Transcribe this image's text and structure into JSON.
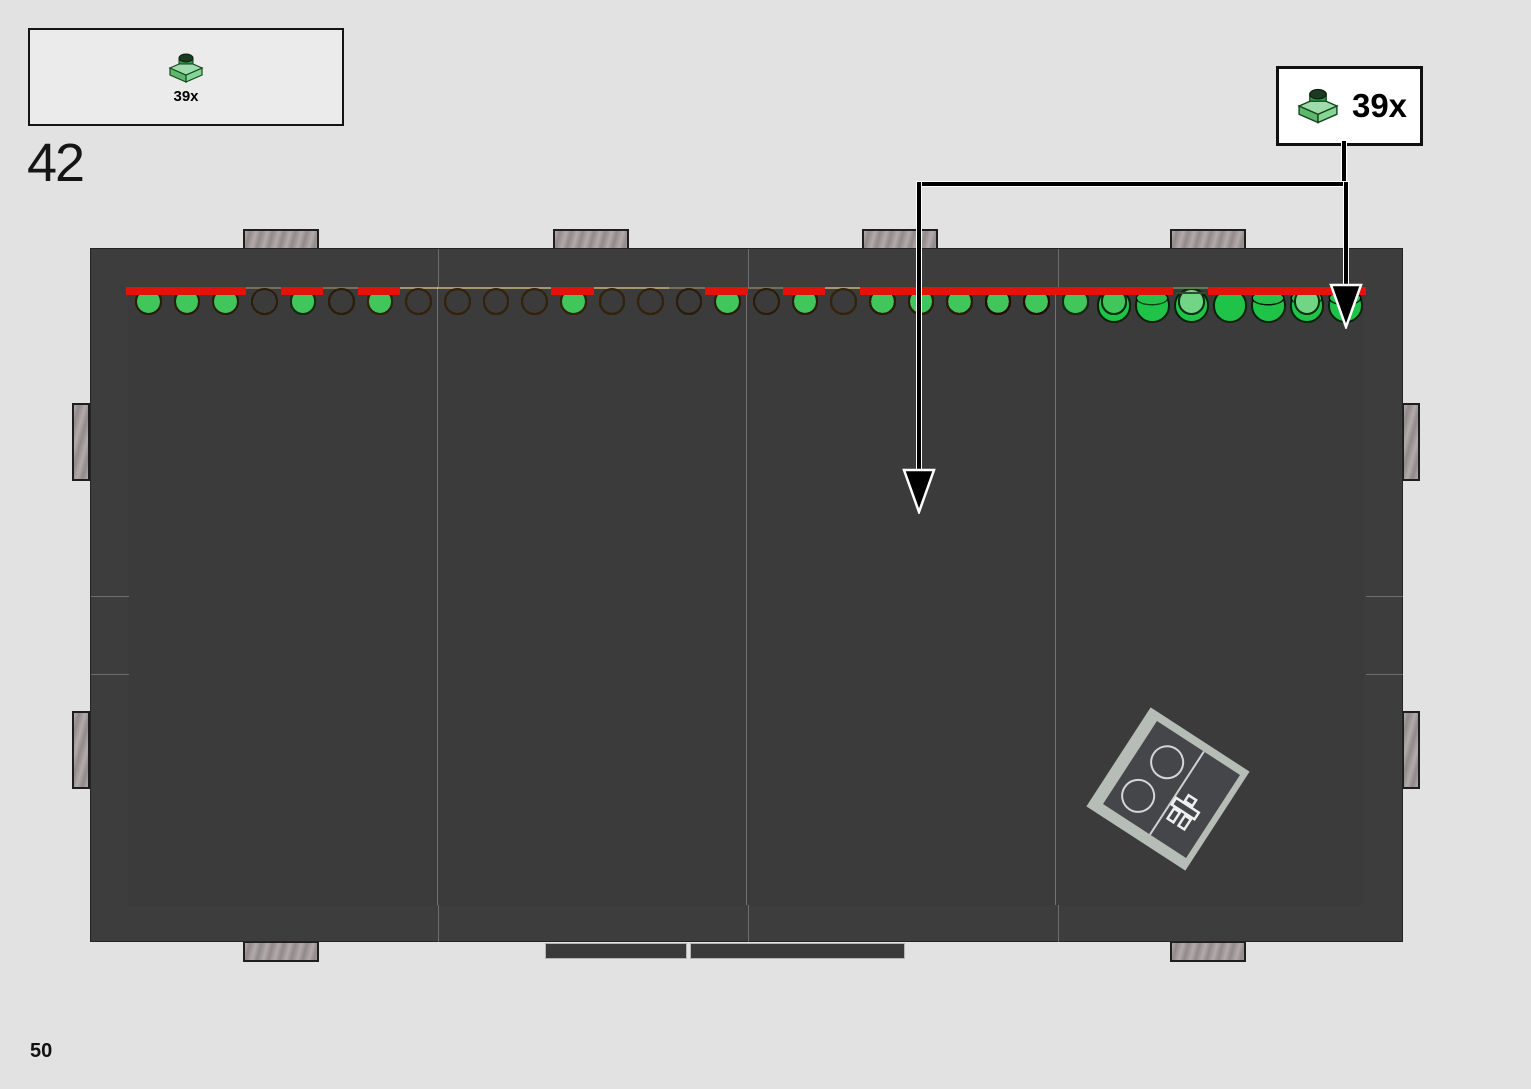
{
  "step": {
    "number": "42"
  },
  "parts_box": {
    "quantity": "39x",
    "part": "green-1x1-plate"
  },
  "callout": {
    "quantity": "39x",
    "part": "green-1x1-plate"
  },
  "page": {
    "number": "50"
  },
  "colors": {
    "page_bg": "#e2e2e2",
    "frame": "#3d3d3d",
    "red_outline": "#e41309",
    "plate_green": "#41c65b",
    "tan": "#e4d097",
    "reddish_brown": "#6f3b20"
  },
  "board": {
    "cols": 32,
    "rows": [
      "LDDDDLLDDDDLLDDDDLLttgggggtttkBB",
      "LDDDDLLDDDDLLDDDDLLttgttkgttgkBg",
      "DDDDDDDDDDDDDDDDDDDtttgcgkgkkkgB",
      "DDDDDDDDDDDDDDDDDDDttcckkgkkkbgB",
      "DDDDDDDDDDDDDDDDDDDttgkkkkkkkggB",
      "LLLLLLMMMMMMMMMMMMtttkkkkgcckkgB",
      "LLLLLLMMMMMMMMMMMMttggckkccckBBB",
      "DDDDLLMMMMMMMMMMDDtttccggkkkggBB",
      "DDDDLLMMMMMMMMMMMMtgttkkkkgkBBBB",
      "LLMMMMMMMMMMMMMMMMtttcckkkbbBBgg",
      "LLttttMMMMMMMMMMtttttcckkeeqqeGe",
      "ttttttMMMMMMMMMMtttttkkkgGeGedqG",
      "tttttttttttttttttgttgkcggGeelgrr",
      "ggttgtttttttttttttttkkkkggellGGq",
      "gtgkttgttttgtttgttttkkBBBgGdlrrq",
      "kkkkgkttttttttkkkktkkkBBggrdGrlr"
    ],
    "palette": {
      "D": {
        "bg": "#3b3b3b",
        "line": "#c6c6c6",
        "stud": "none"
      },
      "L": {
        "bg": "#bdbdbd",
        "line": "#1c1c1c",
        "stud": "none"
      },
      "M": {
        "bg": "#b1aeaa",
        "line": "#1c1c1c",
        "stud": "none"
      },
      "t": {
        "bg": "#e4d097",
        "line": "#33230c",
        "stud": "none"
      },
      "c": {
        "bg": "#eee1b6",
        "line": "#33230c",
        "stud": "none"
      },
      "k": {
        "bg": "#a79778",
        "line": "#2a1d0c",
        "stud": "none"
      },
      "B": {
        "bg": "#6f3b20",
        "line": "#210f06",
        "stud": "none"
      },
      "b": {
        "bg": "#4a280f",
        "line": "#190c04",
        "stud": "none"
      },
      "g": {
        "bg": "#92cb92",
        "line": "#0f2d12",
        "stud": "#41c65b",
        "inset": true
      },
      "e": {
        "bg": "#76ae72",
        "line": "#0f2d12",
        "stud": "#41c65b",
        "inset": true
      },
      "l": {
        "bg": "#bce9bc",
        "line": "#0f2d12",
        "stud": "#72d586",
        "inset": true
      },
      "G": {
        "bg": "#68b168",
        "line": "#02220a",
        "stud": "#1fc348",
        "big": true
      },
      "q": {
        "bg": "#bce9bc",
        "tile": "#9cdfa9"
      },
      "d": {
        "bg": "#80ad73",
        "tile": "#6ea263"
      },
      "r": {
        "bg": "#a9e0a9",
        "ring": "#25c14b"
      }
    },
    "red_groups": [
      [
        22,
        2,
        1,
        1
      ],
      [
        26,
        2,
        1,
        1
      ],
      [
        29,
        2,
        1,
        1
      ],
      [
        32,
        2,
        1,
        1
      ],
      [
        23,
        3,
        1,
        1
      ],
      [
        25,
        3,
        1,
        1
      ],
      [
        27,
        3,
        1,
        1
      ],
      [
        31,
        3,
        1,
        4
      ],
      [
        30,
        5,
        1,
        1
      ],
      [
        26,
        4,
        1,
        1
      ],
      [
        26,
        6,
        1,
        1
      ],
      [
        21,
        7,
        2,
        1
      ],
      [
        24,
        8,
        2,
        1
      ],
      [
        29,
        8,
        2,
        1
      ],
      [
        20,
        9,
        1,
        1
      ],
      [
        27,
        9,
        1,
        1
      ],
      [
        31,
        10,
        2,
        1
      ],
      [
        25,
        12,
        1,
        3
      ],
      [
        18,
        13,
        1,
        1
      ],
      [
        21,
        13,
        1,
        1
      ],
      [
        24,
        13,
        1,
        1
      ],
      [
        1,
        14,
        2,
        1
      ],
      [
        5,
        14,
        1,
        1
      ],
      [
        1,
        15,
        1,
        1
      ],
      [
        3,
        15,
        1,
        1
      ],
      [
        7,
        15,
        1,
        1
      ],
      [
        12,
        15,
        1,
        1
      ],
      [
        16,
        15,
        1,
        1
      ],
      [
        5,
        16,
        1,
        1
      ],
      [
        25,
        16,
        1,
        1
      ]
    ],
    "seams_x": [
      309,
      618,
      927
    ],
    "frame_seams": {
      "top_x": [
        347,
        657,
        967
      ],
      "side_y": [
        309,
        387
      ]
    },
    "clips": {
      "top_x": [
        243,
        553,
        862,
        1170
      ],
      "bottom_x": [
        243,
        1170
      ],
      "left_y": [
        403,
        711
      ],
      "right_y": [
        403,
        711
      ]
    },
    "rails": [
      [
        545,
        943,
        142,
        16
      ],
      [
        690,
        943,
        215,
        16
      ]
    ]
  },
  "arrows": {
    "shafts": [
      [
        1342,
        141,
        4,
        45
      ],
      [
        918,
        182,
        429,
        4
      ],
      [
        917,
        182,
        4,
        290
      ],
      [
        1344,
        182,
        4,
        104
      ]
    ],
    "heads": [
      [
        919,
        514
      ],
      [
        1346,
        329
      ]
    ]
  },
  "rotated_piece": {
    "cx": 1168,
    "cy": 789,
    "angle": 33,
    "light_size": 118,
    "dark_size": 99
  }
}
